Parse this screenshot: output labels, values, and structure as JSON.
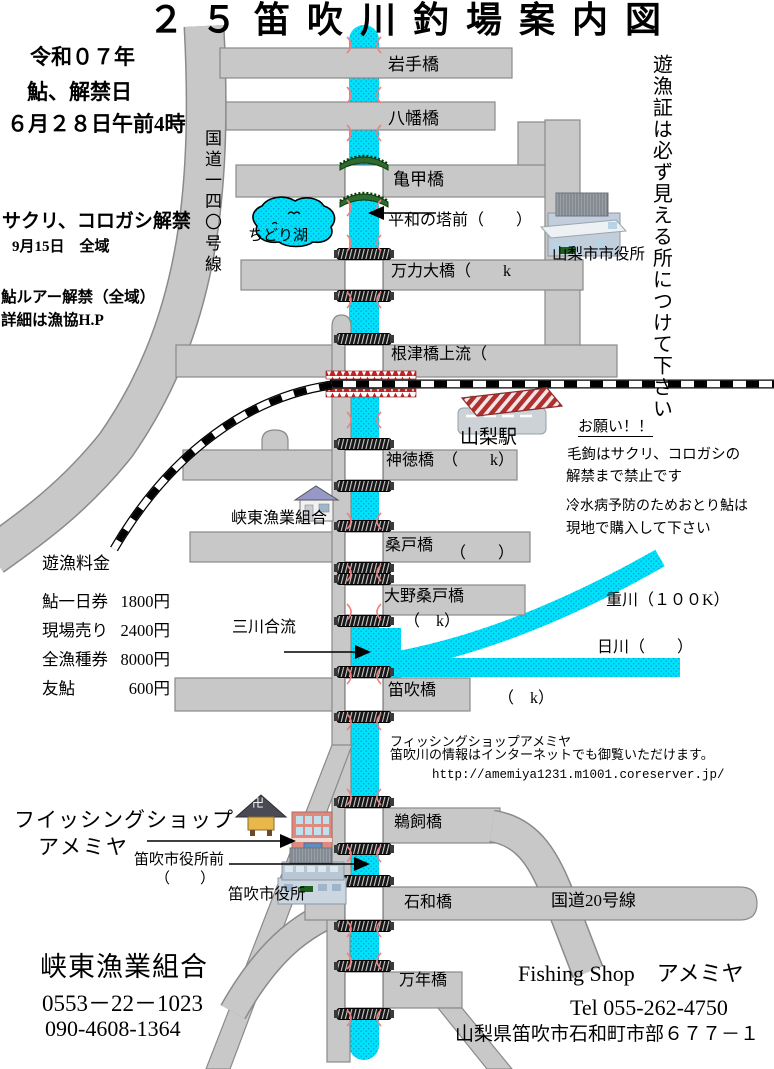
{
  "title": "２５笛吹川釣場案内図",
  "info_left": {
    "era": "令和０７年",
    "ayu": "鮎、解禁日",
    "open_date": "６月２８日午前4時",
    "sakuri": "サクリ、コロガシ解禁",
    "sakuri_date": "9月15日　全域",
    "lure": "鮎ルアー解禁（全域）",
    "lure_detail": "詳細は漁協H.P"
  },
  "roads": {
    "route140": "国道一四〇号線",
    "route20": "国道20号線"
  },
  "lake": {
    "name": "ちどり湖"
  },
  "right_notice_vertical": "遊漁証は必ず見える所につけて下さい",
  "bridges": {
    "iwate": "岩手橋",
    "yahata": "八幡橋",
    "kikko": "亀甲橋",
    "heiwa": "平和の塔前（　　）",
    "manriki": "万力大橋（　　k",
    "nezu": "根津橋上流（",
    "jintoku": "神徳橋　（　　k）",
    "kuwado": "桑戸橋",
    "kuwado_paren": "（　　）",
    "onokuwado": "大野桑戸橋",
    "onokuwado_paren": "（　k）",
    "fuefuki": "笛吹橋",
    "fuefuki_paren": "（　k）",
    "ukai": "鵜飼橋",
    "isawa": "石和橋",
    "mannen": "万年橋"
  },
  "places": {
    "yamanashi_station": "山梨駅",
    "yamanashi_cityhall": "山梨市市役所",
    "kyoto_coop": "峡東漁業組合",
    "fuefuki_cityhall": "笛吹市役所",
    "fuefuki_cityhall_mae": "笛吹市役所前",
    "fuefuki_cityhall_mae_paren": "（　　）",
    "sankawa": "三川合流",
    "omokawa": "重川（１００K）",
    "hikawa": "日川（　　）"
  },
  "request_note": {
    "heading": "お願い！！",
    "line1": "毛鉤はサクリ、コロガシの",
    "line2": "解禁まで禁止です",
    "line3": "冷水病予防のためおとり鮎は",
    "line4": "現地で購入して下さい"
  },
  "fees": {
    "heading": "遊漁料金",
    "rows": [
      {
        "label": "鮎一日券",
        "value": "1800円"
      },
      {
        "label": "現場売り",
        "value": "2400円"
      },
      {
        "label": "全漁種券",
        "value": "8000円"
      },
      {
        "label": "友鮎",
        "value": "600円"
      }
    ]
  },
  "shop_note": {
    "line1": "フィッシングショップアメミヤ",
    "line2": "笛吹川の情報はインターネットでも御覧いただけます。",
    "url": "http://amemiya1231.m1001.coreserver.jp/"
  },
  "shop_label": {
    "line1": "フイッシングショップ",
    "line2": "アメミヤ"
  },
  "coop_contact": {
    "name": "峡東漁業組合",
    "tel1": "0553－22－1023",
    "tel2": "090-4608-1364"
  },
  "shop_contact": {
    "name": "Fishing Shop　アメミヤ",
    "tel": "Tel 055-262-4750",
    "address": "山梨県笛吹市石和町市部６７７－１"
  },
  "icons": {
    "manji": "卍"
  },
  "colors": {
    "river": "#00E2FC",
    "river_dot": "#00A5CF",
    "road": "#C8C8C8",
    "road_edge": "#8A8A8A",
    "rail_red": "#C62222",
    "mark_red": "#F08080"
  }
}
